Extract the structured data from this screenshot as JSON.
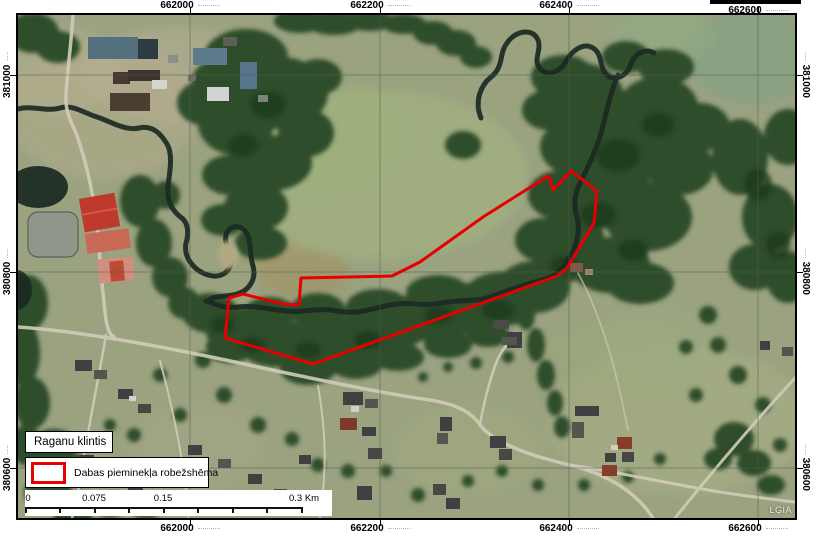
{
  "legend": {
    "title": "Raganu klintis",
    "item": {
      "label": "Dabas pieminekļa robežshēma",
      "symbol_color": "#e60000"
    }
  },
  "scalebar": {
    "labels": [
      "0",
      "0.075",
      "0.15",
      "0.3 Km"
    ]
  },
  "credit": "LĢIA",
  "grid": {
    "top_labels": [
      "662000",
      "662200",
      "662400",
      "662600"
    ],
    "bottom_labels": [
      "662000",
      "662200",
      "662400",
      "662600"
    ],
    "left_labels": [
      "381000",
      "380800",
      "380600"
    ],
    "right_labels": [
      "381000",
      "380800",
      "380600"
    ]
  },
  "boundary": {
    "label": "Dabas pieminekļa robežshēma",
    "stroke_color": "#e60000",
    "points": "402,247 465,202 519,168 531,161 535,175 553,156 579,176 576,208 549,253 539,261 295,349 207,323 211,283 225,279 265,289 281,290 283,263 374,261"
  }
}
